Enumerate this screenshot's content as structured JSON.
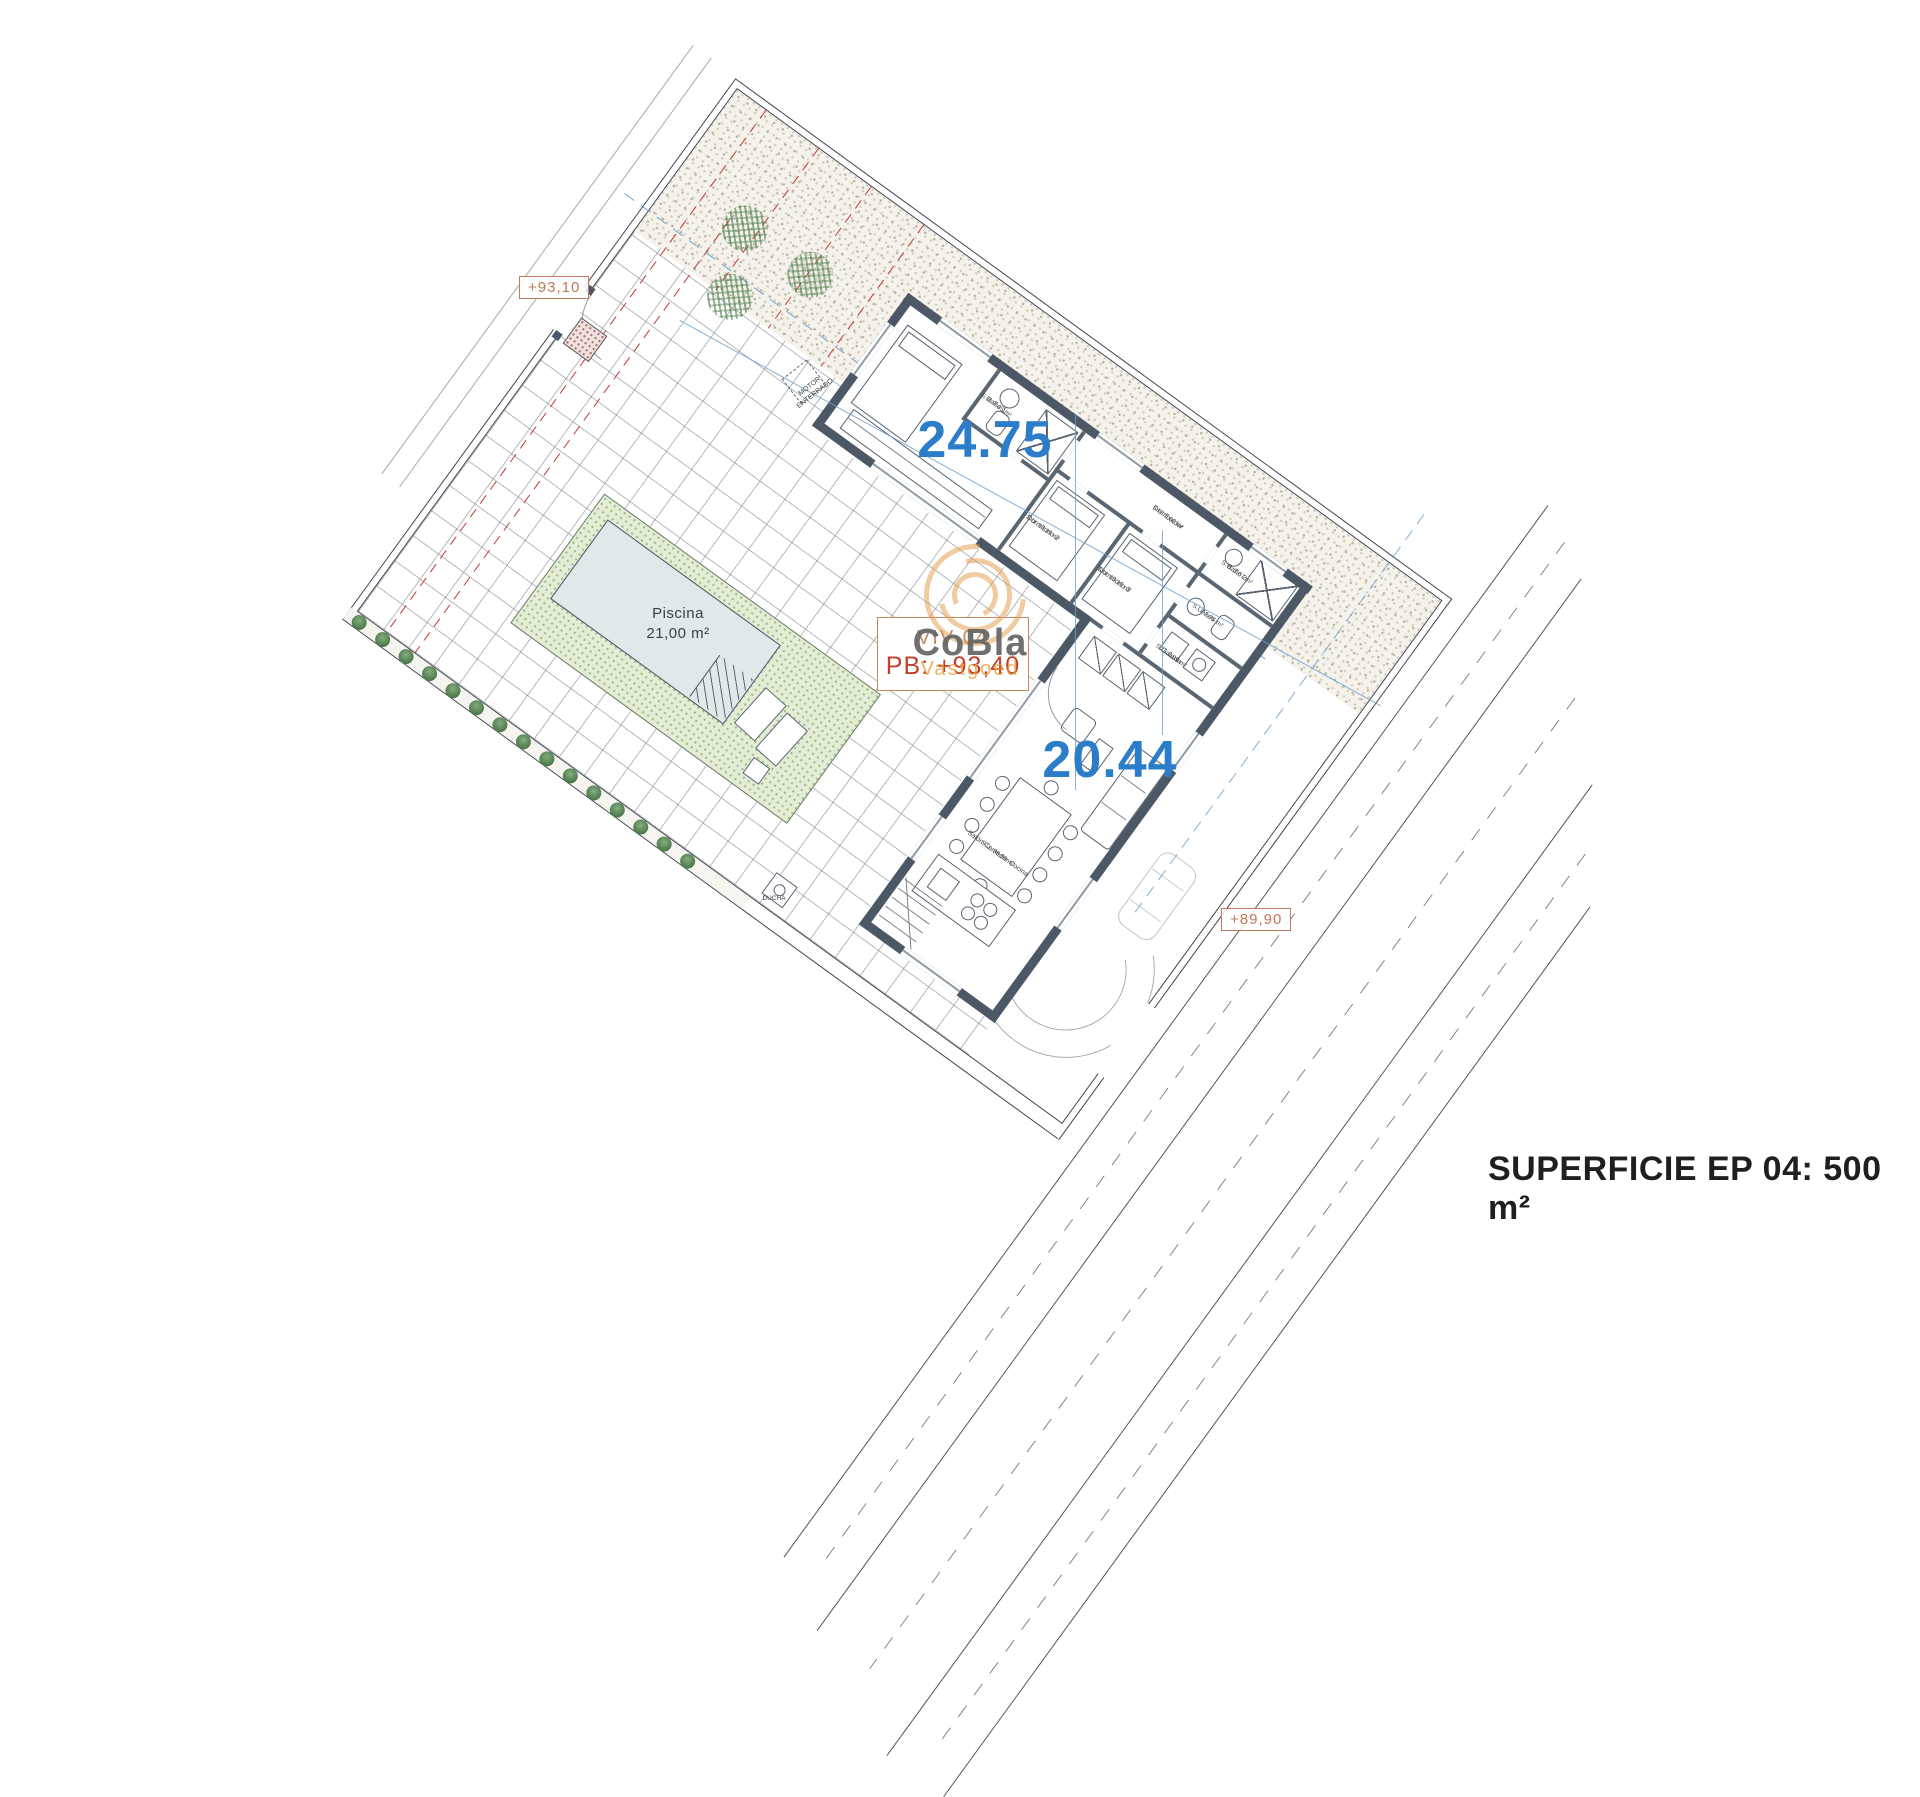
{
  "areas": {
    "north": "24.75",
    "south": "20.44"
  },
  "levels": {
    "upper": "+93,10",
    "lower": "+89,90"
  },
  "villa": {
    "id": "VIV 04",
    "floor": "PB: +93,40"
  },
  "pool": {
    "name": "Piscina",
    "area": "21,00 m²"
  },
  "watermark": {
    "brand": "CoBla",
    "sub": "Vastgoed"
  },
  "footer": {
    "superficie": "SUPERFICIE EP 04: 500 m²"
  },
  "labels": {
    "motor_line1": "MOTOR",
    "motor_line2": "ENTERRADO",
    "ducha": "DUCHA"
  },
  "rooms": {
    "dormitorio2": {
      "name": "Dormitorio 2",
      "area": "S.U: 10,19 m²"
    },
    "dormitorio3": {
      "name": "Dormitorio 3",
      "area": "S.U: 10,19 m²"
    },
    "distribuidor": {
      "name": "Distribuidor",
      "area": "S.U: 5,60 m²"
    },
    "banio1": {
      "name": "Baño 1",
      "area": "S.U: 3,45 m²"
    },
    "banio2": {
      "name": "Baño 2",
      "area": "S.U: 3,67 m²"
    },
    "aseo": {
      "name": "Aseo",
      "area": "S.U: 2,76 m²"
    },
    "galeria": {
      "name": "Galería",
      "area": "S.U: 2,09 m²"
    },
    "salon": {
      "name": "Salón-Comedor-Cocina",
      "area": "S.U: 35,09 m²"
    }
  },
  "colors": {
    "accent_blue": "#2b7cc9",
    "accent_orange": "#c8875f",
    "accent_red": "#c0402c",
    "wall": "#4d5866",
    "pool_band": "#e3ecd4",
    "pool_water": "#e1e8ea",
    "red_dash": "#c23a35",
    "blue_guide": "#649bcd",
    "watermark_gray": "#646464",
    "watermark_orange": "#e69e3a"
  }
}
